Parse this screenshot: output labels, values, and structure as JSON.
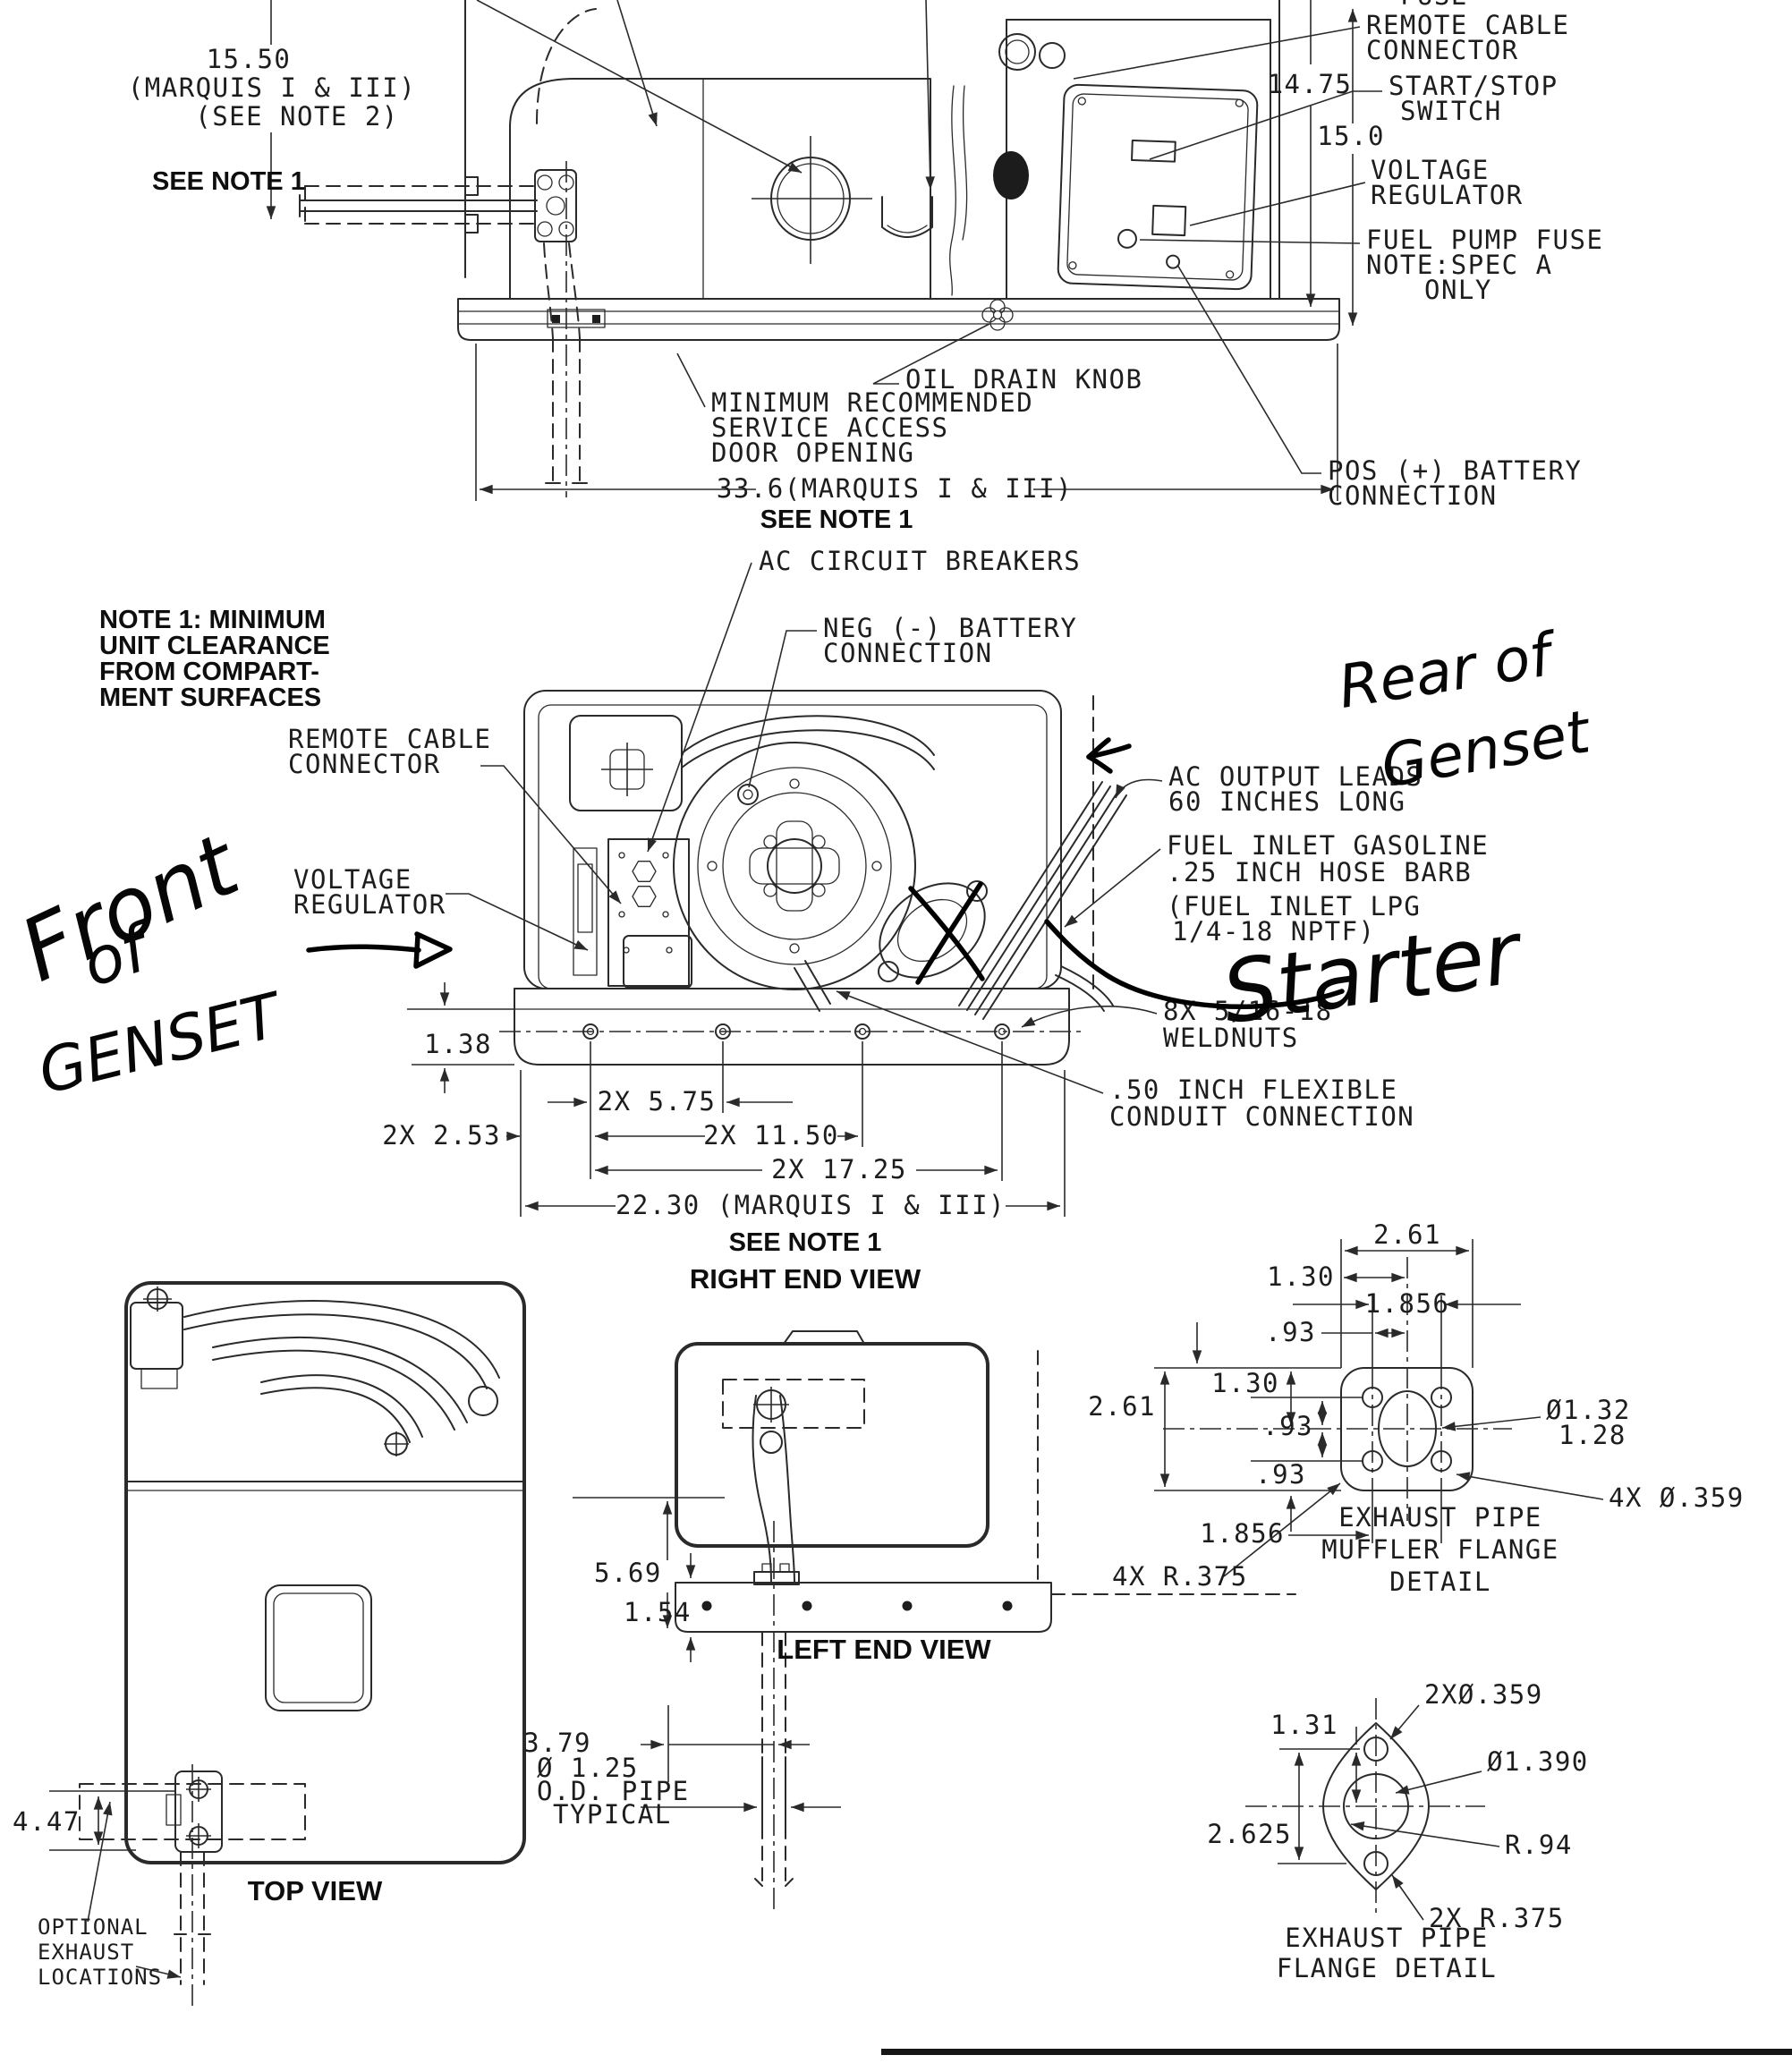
{
  "handwritten": {
    "front": {
      "l1": "Front",
      "l2": "of",
      "l3": "GENSET"
    },
    "rear": {
      "l1": "Rear of",
      "l2": "Genset"
    },
    "starter": "Starter"
  },
  "front_view": {
    "clipped_label": "FUSE",
    "dim_height": {
      "l1": "15.50",
      "l2": "(MARQUIS I & III)",
      "l3": "(SEE NOTE 2)"
    },
    "see_note_left": "SEE NOTE 1",
    "dim_14_75": "14.75",
    "dim_15_0": "15.0",
    "remote_cable": {
      "l1": "REMOTE CABLE",
      "l2": "CONNECTOR"
    },
    "start_stop": {
      "l1": "START/STOP",
      "l2": "SWITCH"
    },
    "voltage_regulator": {
      "l1": "VOLTAGE",
      "l2": "REGULATOR"
    },
    "fuel_pump_fuse": {
      "l1": "FUEL PUMP FUSE",
      "l2": "NOTE:SPEC A",
      "l3": "ONLY"
    },
    "oil_drain_knob": "OIL DRAIN KNOB",
    "service_access": {
      "l1": "MINIMUM RECOMMENDED",
      "l2": "SERVICE ACCESS",
      "l3": "DOOR OPENING"
    },
    "dim_width": "33.6(MARQUIS I & III)",
    "see_note_bottom": "SEE NOTE 1",
    "pos_battery": {
      "l1": "POS (+) BATTERY",
      "l2": "CONNECTION"
    }
  },
  "note1": {
    "l1": "NOTE 1: MINIMUM",
    "l2": "UNIT CLEARANCE",
    "l3": "FROM COMPART-",
    "l4": "MENT SURFACES"
  },
  "right_end_view": {
    "ac_breakers": "AC CIRCUIT BREAKERS",
    "neg_battery": {
      "l1": "NEG (-) BATTERY",
      "l2": "CONNECTION"
    },
    "remote_cable": {
      "l1": "REMOTE CABLE",
      "l2": "CONNECTOR"
    },
    "voltage_regulator": {
      "l1": "VOLTAGE",
      "l2": "REGULATOR"
    },
    "ac_output": {
      "l1": "AC OUTPUT LEADS",
      "l2": "60 INCHES LONG"
    },
    "fuel_inlet": {
      "l1": "FUEL INLET GASOLINE",
      "l2": ".25 INCH HOSE BARB",
      "l3": "(FUEL INLET LPG",
      "l4": "1/4-18 NPTF)"
    },
    "weldnuts": {
      "l1": "8X 5/16-18",
      "l2": "WELDNUTS"
    },
    "conduit": {
      "l1": ".50 INCH FLEXIBLE",
      "l2": "CONDUIT CONNECTION"
    },
    "dim_1_38": "1.38",
    "dim_5_75": "2X 5.75",
    "dim_2_53": "2X 2.53",
    "dim_11_50": "2X 11.50",
    "dim_17_25": "2X 17.25",
    "dim_22_30": "22.30 (MARQUIS I & III)",
    "see_note": "SEE NOTE 1",
    "title": "RIGHT END VIEW"
  },
  "top_view": {
    "dim_4_47": "4.47",
    "optional_exhaust": {
      "l1": "OPTIONAL",
      "l2": "EXHAUST",
      "l3": "LOCATIONS"
    },
    "title": "TOP VIEW"
  },
  "left_end_view": {
    "dim_5_69": "5.69",
    "dim_1_54": "1.54",
    "dim_3_79": "3.79",
    "pipe_note": {
      "l1": "Ø 1.25",
      "l2": "O.D. PIPE",
      "l3": "TYPICAL"
    },
    "title": "LEFT END VIEW"
  },
  "muffler_flange": {
    "dim_2_61_top": "2.61",
    "dim_1_30_top": "1.30",
    "dim_1_856_top": "1.856",
    "dim_93_top": ".93",
    "dim_2_61_left": "2.61",
    "dim_1_30_left": "1.30",
    "dim_93_upper": ".93",
    "dim_93_lower": ".93",
    "bore": {
      "l1": "Ø1.32",
      "l2": "1.28"
    },
    "holes": "4X Ø.359",
    "dim_1_856_bottom": "1.856",
    "corner_radius": "4X R.375",
    "title": {
      "l1": "EXHAUST PIPE",
      "l2": "MUFFLER FLANGE",
      "l3": "DETAIL"
    }
  },
  "flange": {
    "dim_1_31": "1.31",
    "dim_2_625": "2.625",
    "holes": "2XØ.359",
    "bore": "Ø1.390",
    "radius": "R.94",
    "end_radius": "2X R.375",
    "title": {
      "l1": "EXHAUST PIPE",
      "l2": "FLANGE DETAIL"
    }
  }
}
